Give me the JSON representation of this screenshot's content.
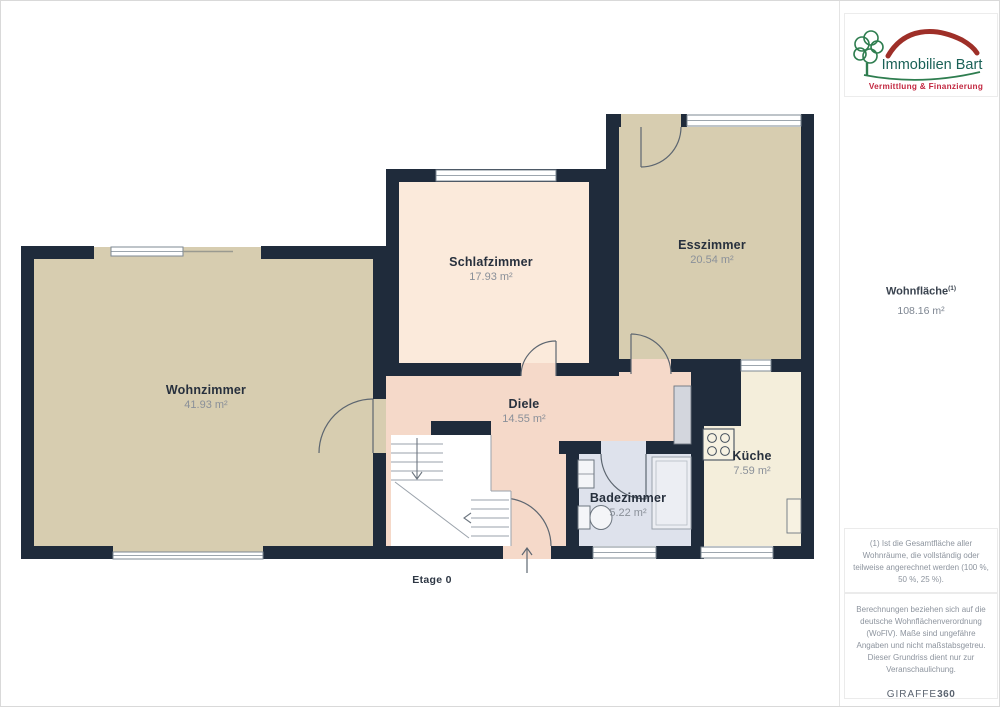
{
  "sidebar": {
    "logo": {
      "brand": "Immobilien Bart",
      "tagline": "Vermittlung & Finanzierung",
      "brand_color": "#1a6157",
      "roof_color": "#9e2f28",
      "tagline_color": "#c22740",
      "tree_color": "#2e7d4f"
    },
    "area_summary": {
      "label": "Wohnfläche",
      "superscript": "(1)",
      "value": "108.16 m²"
    },
    "footnote": "(1) Ist die Gesamtfläche aller Wohnräume, die vollständig oder teilweise angerechnet werden (100 %, 50 %, 25 %).",
    "disclaimer": "Berechnungen beziehen sich auf die deutsche Wohnflächenverordnung (WoFlV). Maße sind ungefähre Angaben und nicht maßstabsgetreu. Dieser Grundriss dient nur zur Veranschaulichung.",
    "watermark": {
      "brand": "GIRAFFE",
      "suffix": "360"
    }
  },
  "floorplan": {
    "floor_label": "Etage 0",
    "rooms": {
      "wohnzimmer": {
        "name": "Wohnzimmer",
        "area": "41.93 m²"
      },
      "schlafzimmer": {
        "name": "Schlafzimmer",
        "area": "17.93 m²"
      },
      "esszimmer": {
        "name": "Esszimmer",
        "area": "20.54 m²"
      },
      "diele": {
        "name": "Diele",
        "area": "14.55 m²"
      },
      "badezimmer": {
        "name": "Badezimmer",
        "area": "5.22 m²"
      },
      "kueche": {
        "name": "Küche",
        "area": "7.59 m²"
      }
    },
    "colors": {
      "wall": "#1f2b3b",
      "wohnzimmer": "#d7cdb0",
      "esszimmer": "#d7cdb0",
      "schlafzimmer": "#fbeadb",
      "diele": "#f5d9c9",
      "badezimmer": "#dee2ec",
      "kueche": "#f4eedb",
      "door_stroke": "#5d6670",
      "window_stroke": "#7d8893"
    }
  }
}
